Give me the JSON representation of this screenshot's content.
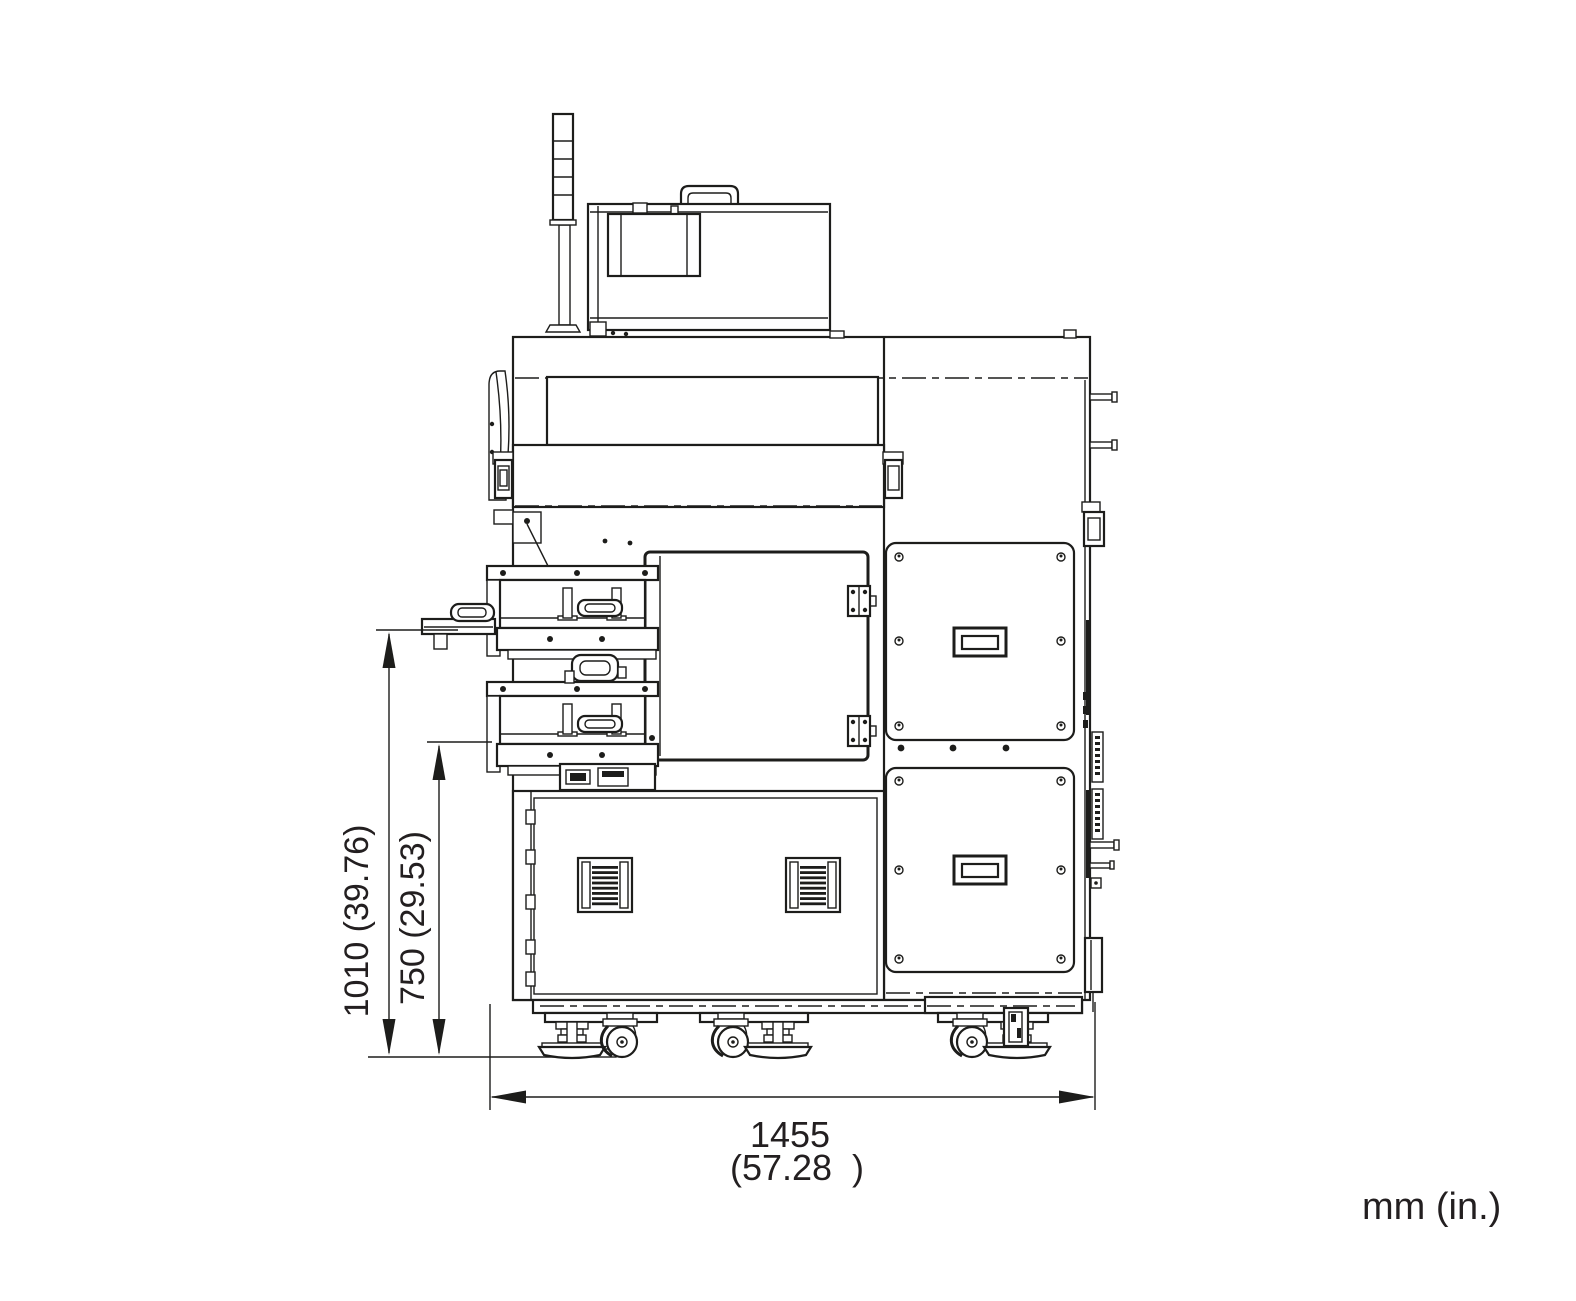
{
  "drawing": {
    "units_label": "mm (in.)",
    "dim_height_overall": "1010 (39.76)",
    "dim_height_platform": "750 (29.53)",
    "dim_width_mm": "1455",
    "dim_width_in": "(57.28  )"
  },
  "colors": {
    "line": "#1d1d1b",
    "text": "#231f20",
    "background": "#ffffff"
  }
}
